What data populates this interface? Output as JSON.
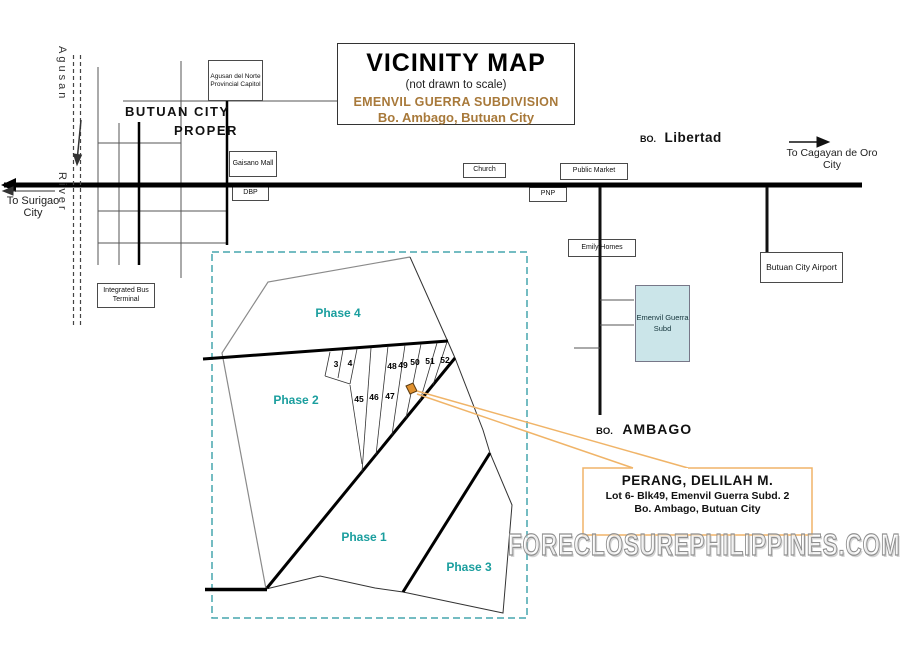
{
  "title_box": {
    "title": "VICINITY MAP",
    "subtitle": "(not drawn to scale)",
    "subdivision": "EMENVIL GUERRA SUBDIVISION",
    "location": "Bo. Ambago, Butuan City"
  },
  "river": {
    "name_top": "Agusan",
    "name_bottom": "River"
  },
  "directions": {
    "to_surigao_line1": "To Surigao",
    "to_surigao_line2": "City",
    "to_cagayan_line1": "To Cagayan de Oro",
    "to_cagayan_line2": "City"
  },
  "areas": {
    "butuan_city": "BUTUAN CITY",
    "proper": "PROPER",
    "libertad_prefix": "BO.",
    "libertad": "Libertad",
    "ambago_prefix": "BO.",
    "ambago": "AMBAGO"
  },
  "landmarks": {
    "capitol": "Agusan del Norte Provincial Capitol",
    "gaisano_mall": "Gaisano Mall",
    "dbp": "DBP",
    "church": "Church",
    "public_market": "Public Market",
    "pnp": "PNP",
    "emily_homes": "Emily Homes",
    "emenvil_subd": "Emenvil Guerra Subd",
    "airport": "Butuan City Airport",
    "bus_terminal": "Integrated Bus Terminal"
  },
  "plat": {
    "phases": [
      "Phase 4",
      "Phase 2",
      "Phase 1",
      "Phase 3"
    ],
    "lots": [
      "3",
      "4",
      "48",
      "49",
      "50",
      "51",
      "52",
      "45",
      "46",
      "47"
    ]
  },
  "callout": {
    "name": "PERANG, DELILAH M.",
    "line1": "Lot 6- Blk49, Emenvil Guerra Subd. 2",
    "line2": "Bo. Ambago, Butuan City"
  },
  "watermark": "FORECLOSUREPHILIPPINES.COM",
  "colors": {
    "subdivision_text": "#a8793a",
    "phase_text": "#1a9e9e",
    "callout_border": "#f0b468",
    "subject_lot_fill": "#e0912f",
    "emenvil_box_fill": "#cbe5e9",
    "plat_border_dashed": "#46a5ae",
    "watermark_outline": "#8f8f8f"
  }
}
